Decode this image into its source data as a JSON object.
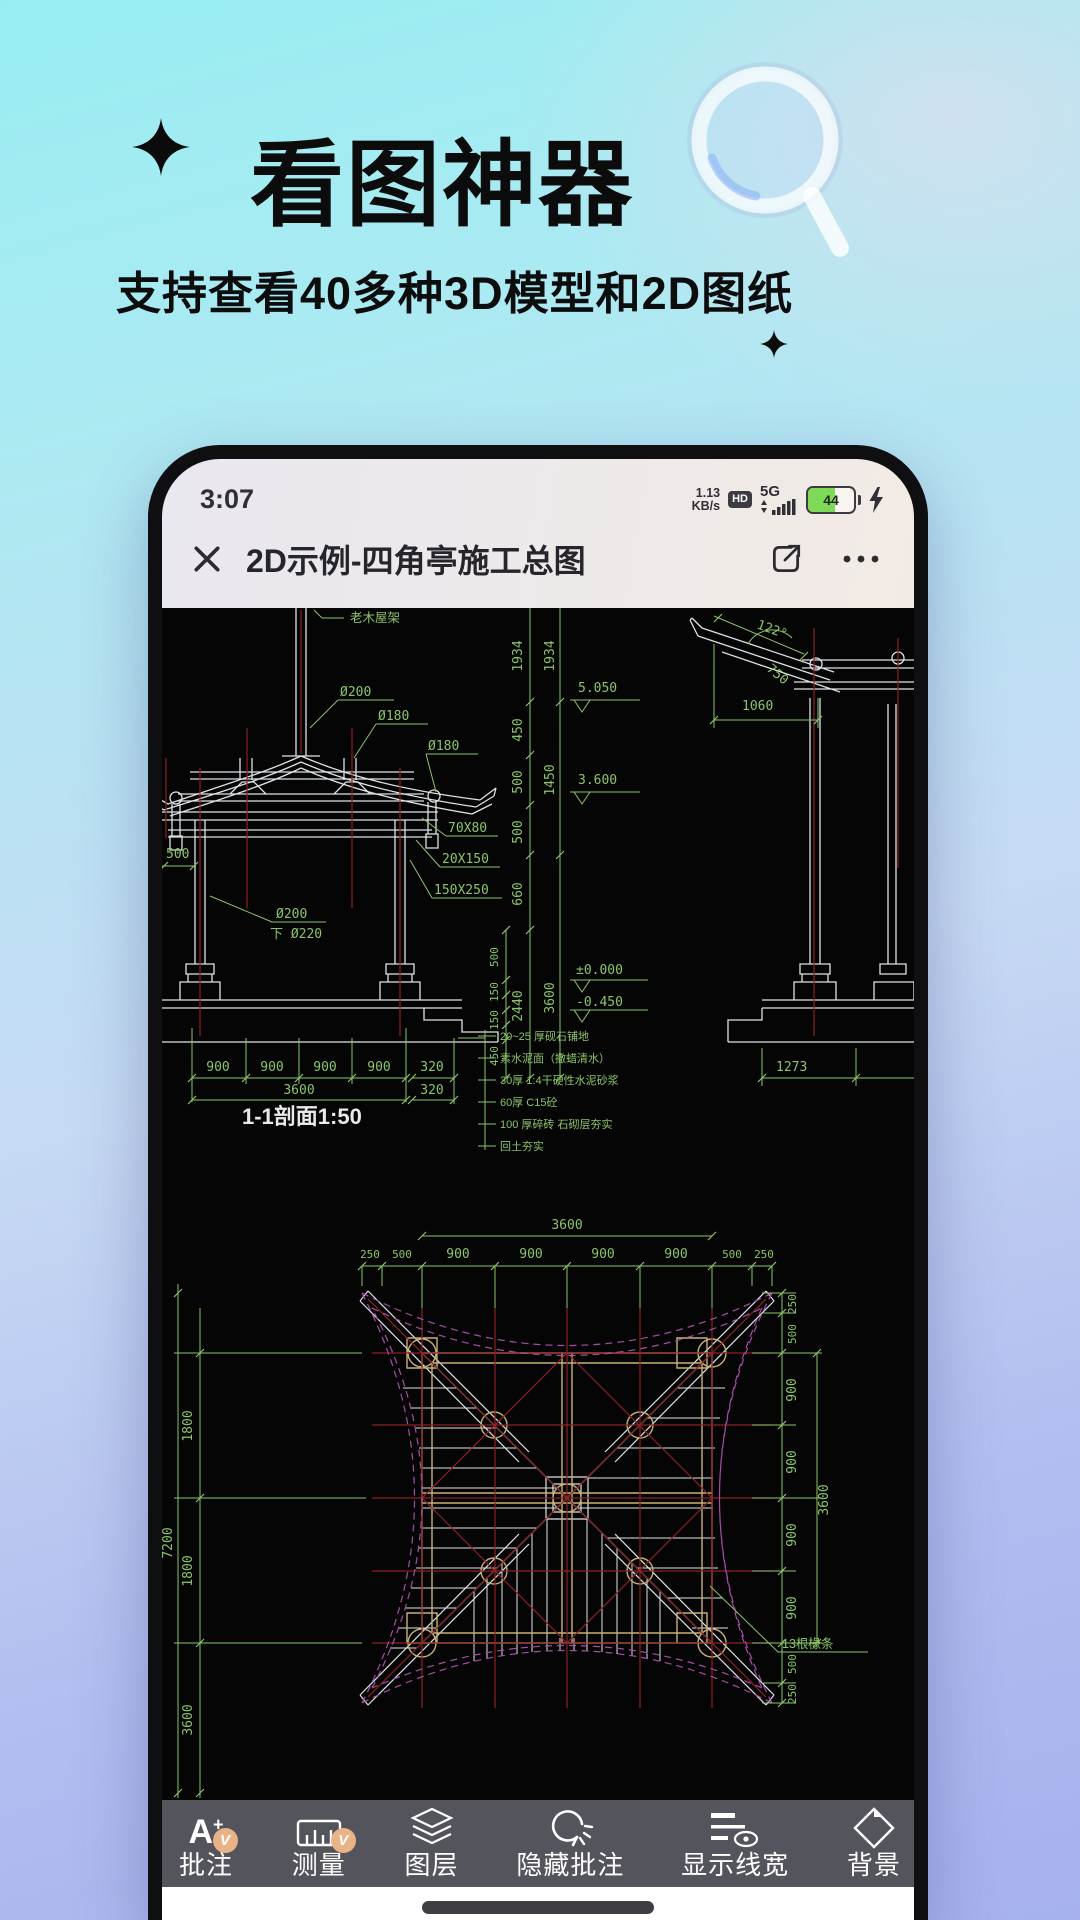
{
  "hero": {
    "title": "看图神器",
    "subtitle": "支持查看40多种3D模型和2D图纸"
  },
  "phone": {
    "status_bar": {
      "time": "3:07",
      "net_speed_value": "1.13",
      "net_speed_unit": "KB/s",
      "hd_badge": "HD",
      "network": "5G",
      "battery_percent": "44"
    },
    "nav_bar": {
      "title": "2D示例-四角亭施工总图"
    },
    "toolbar": {
      "items": [
        {
          "label": "批注",
          "icon": "annotate-a-plus",
          "badge": "V"
        },
        {
          "label": "测量",
          "icon": "measure-ruler",
          "badge": "V"
        },
        {
          "label": "图层",
          "icon": "layers"
        },
        {
          "label": "隐藏批注",
          "icon": "hide-annotations"
        },
        {
          "label": "显示线宽",
          "icon": "line-width-eye"
        },
        {
          "label": "背景",
          "icon": "background-diamond"
        }
      ]
    }
  },
  "cad_section": {
    "title": "1-1剖面1:50",
    "roof_label": "老木屋架",
    "diam_labels": [
      "Ø200",
      "Ø180",
      "Ø180"
    ],
    "beam_labels": [
      "70X80",
      "20X150",
      "150X250"
    ],
    "col_label_line1": "Ø200",
    "col_label_line2": "下 Ø220",
    "left_dim": "500",
    "elevations": [
      "5.050",
      "3.600",
      "±0.000",
      "-0.450"
    ],
    "vchain": [
      "1934",
      "1934",
      "450",
      "500",
      "1450",
      "500",
      "660",
      "2440",
      "3600",
      "500",
      "150",
      "150",
      "450"
    ],
    "bottom_dims": [
      "900",
      "900",
      "900",
      "900"
    ],
    "bottom_total": "3600",
    "edge_dims": [
      "320",
      "320"
    ],
    "materials": [
      "20~25 厚砚石铺地",
      "素水泥面（撒蜡清水）",
      "30厚 1:4干硬性水泥砂浆",
      "60厚 C15砼",
      "100 厚碎砖 石砌层夯实",
      "回土夯实"
    ],
    "detail_dims": {
      "angle": "122°",
      "slope": "750",
      "width": "1060",
      "bottom": "1273"
    }
  },
  "cad_plan": {
    "top_total": "3600",
    "top_dims": [
      "250",
      "500",
      "900",
      "900",
      "900",
      "900",
      "500",
      "250"
    ],
    "right_dims": [
      "250",
      "500",
      "900",
      "900",
      "900",
      "900",
      "500",
      "250"
    ],
    "right_total": "3600",
    "left_dims": [
      "1800",
      "1800",
      "3600"
    ],
    "left_total": "7200",
    "note": "13根椽条"
  },
  "colors": {
    "bg_top": "#97eef1",
    "bg_bottom": "#a6b1ee",
    "cad_white": "#dfe3e6",
    "cad_green": "#8cc569",
    "cad_red": "#8b2222",
    "cad_tan": "#c9b178",
    "cad_purple": "#a44fa8",
    "toolbar_bg": "#54555c",
    "badge_orange": "#e9b387",
    "battery_green": "#7ed957"
  }
}
